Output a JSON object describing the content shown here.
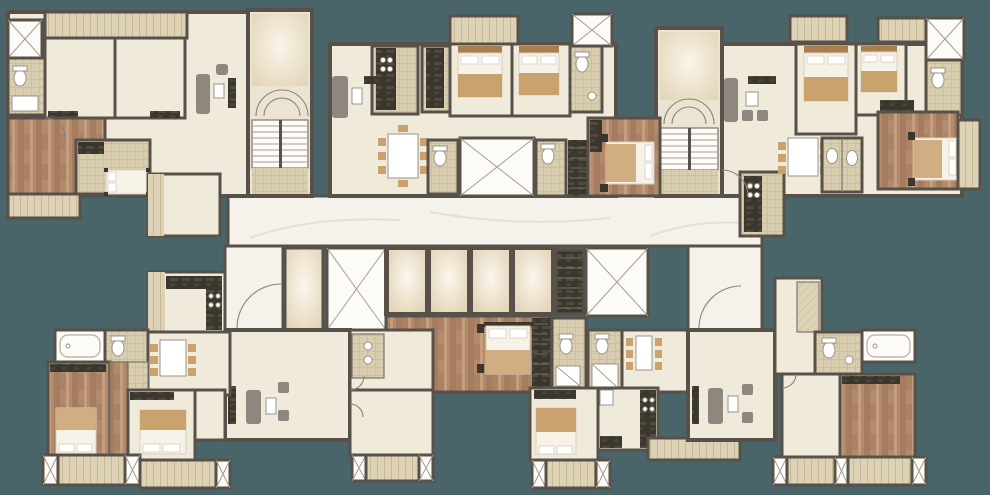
{
  "palette": {
    "background": "#4a6569",
    "wall": "#57514a",
    "wall_light": "#7b756c",
    "floor_cream": "#f0eadb",
    "floor_cream_dark": "#ece4d2",
    "floor_beige": "#d9cdb0",
    "beige_line": "#c3b593",
    "wood": "#b48a6d",
    "wood_dark": "#a1775c",
    "wood_light": "#c9a183",
    "deck": "#ded2b6",
    "deck_line": "#c8b995",
    "white": "#fcfbf8",
    "marble": "#f5f2eb",
    "marble_line": "#e6e0d4",
    "appliance_dark": "#3b372f",
    "glow_center": "#fbf7ee",
    "glow_edge": "#e3d5b8",
    "tan": "#c9a26e",
    "tan_dark": "#a87e4e",
    "furniture_gray": "#8d8780",
    "bed_white": "#f6f2e8",
    "arc": "#8a8278"
  },
  "plan_features": {
    "elevator_shafts": 5,
    "service_shafts": 2,
    "stairwells": 2,
    "residential_units": 6
  }
}
